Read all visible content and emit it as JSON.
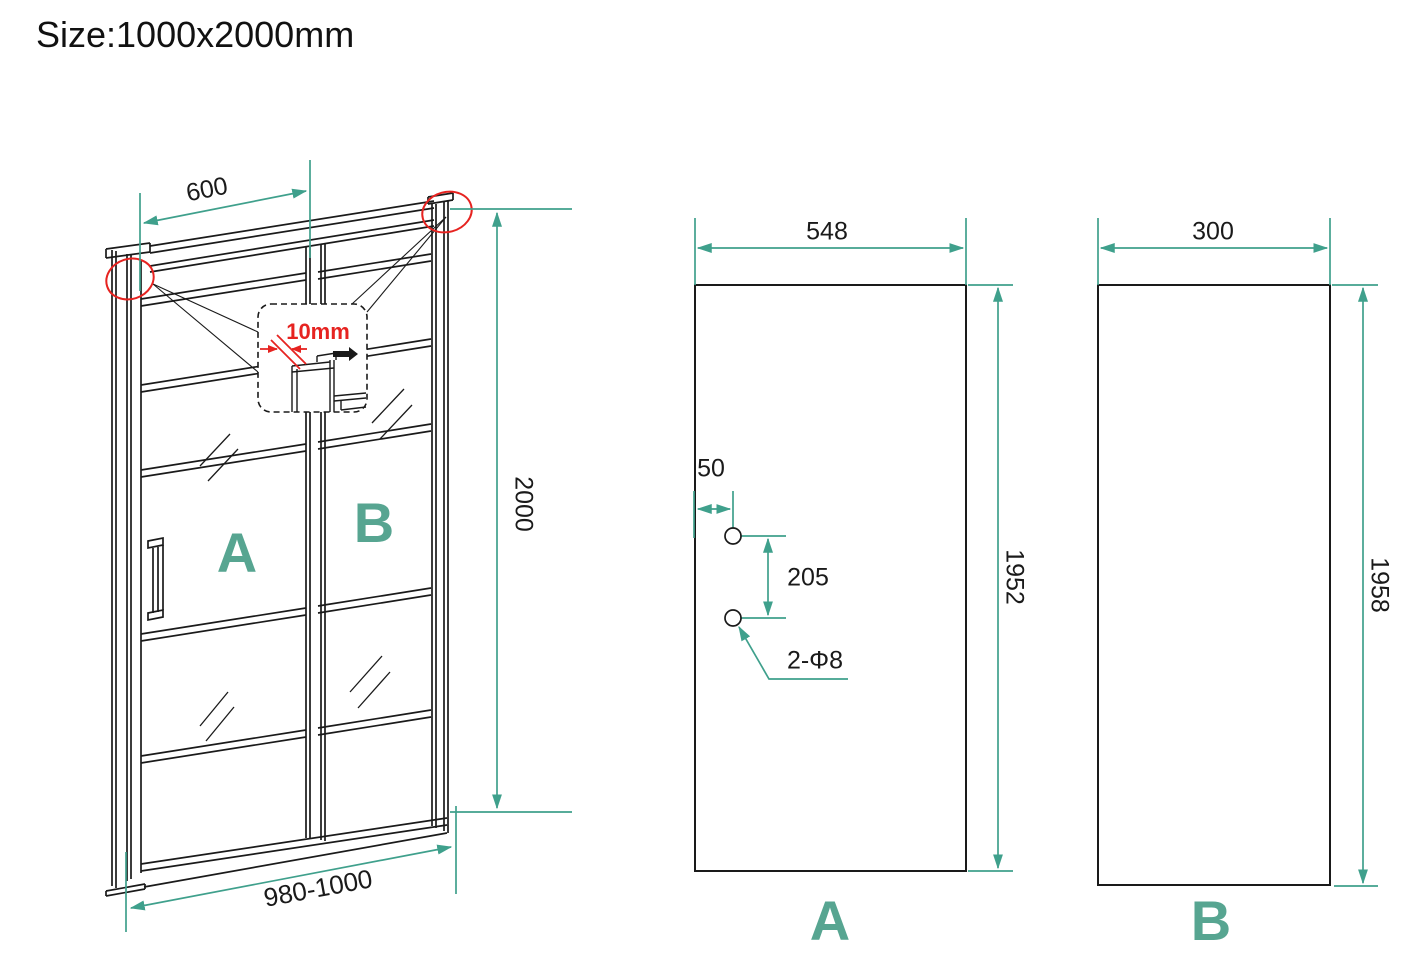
{
  "title": "Size:1000x2000mm",
  "colors": {
    "accent_teal": "#3fa08c",
    "label_teal": "#57a591",
    "detail_red": "#e62320",
    "line_black": "#1a1a1a"
  },
  "front_view": {
    "top_width": "600",
    "overall_height": "2000",
    "bottom_width_range": "980-1000",
    "gap_detail": "10mm",
    "door_panel_label": "A",
    "fixed_panel_label": "B"
  },
  "panel_a_view": {
    "label": "A",
    "width": "548",
    "height": "1952",
    "hole_edge_offset": "50",
    "hole_spacing": "205",
    "hole_spec": "2-Φ8"
  },
  "panel_b_view": {
    "label": "B",
    "width": "300",
    "height": "1958"
  }
}
